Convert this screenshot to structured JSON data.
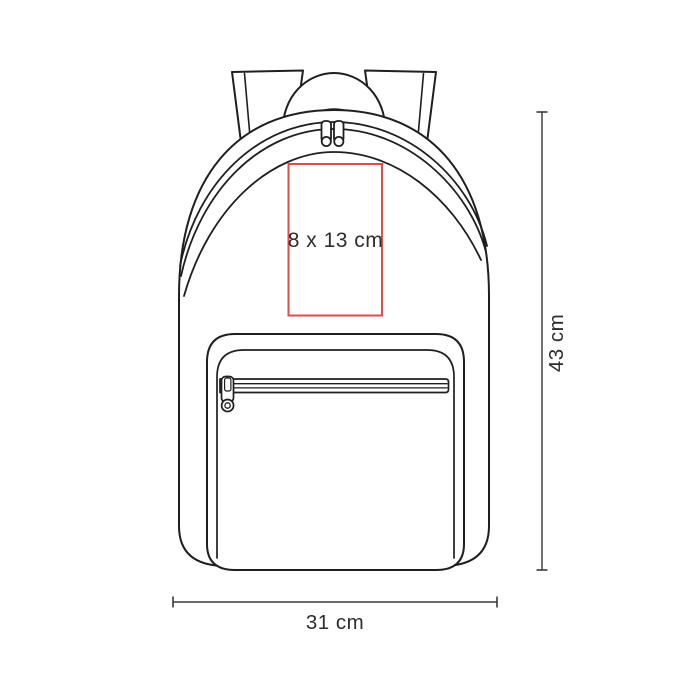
{
  "diagram": {
    "product": "backpack",
    "print_area": {
      "label": "8 x 13 cm",
      "width_cm": 8,
      "height_cm": 13,
      "border_color": "#e04c4c"
    },
    "dimensions": {
      "height": {
        "label": "43 cm",
        "value_cm": 43
      },
      "width": {
        "label": "31 cm",
        "value_cm": 31
      }
    },
    "colors": {
      "line_art": "#1f1f1f",
      "dimension_lines": "#3a3a3a",
      "label_text": "#2d2d2d",
      "background": "#ffffff"
    }
  }
}
